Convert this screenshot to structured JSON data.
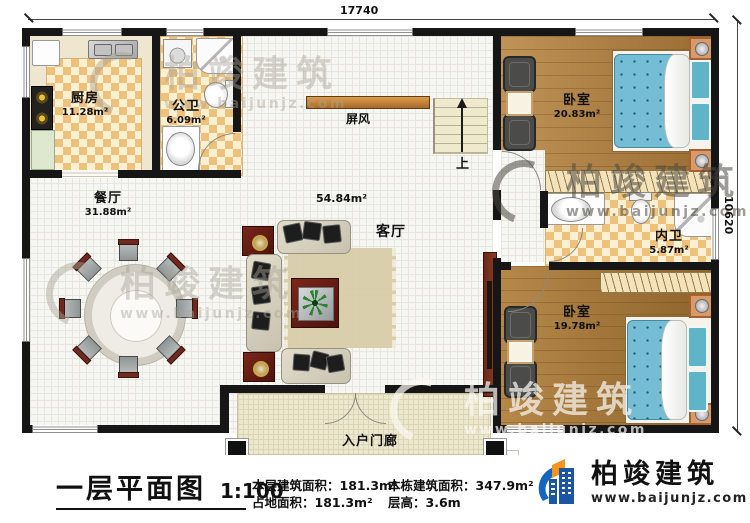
{
  "plan": {
    "dimension_top": "17740",
    "dimension_right": "10620",
    "rooms": {
      "kitchen": {
        "name": "厨房",
        "area": "11.28m²"
      },
      "public_bath": {
        "name": "公卫",
        "area": "6.09m²"
      },
      "dining": {
        "name": "餐厅",
        "area": "31.88m²"
      },
      "living": {
        "name": "客厅",
        "area": "54.84m²"
      },
      "screen": {
        "name": "屏风"
      },
      "stairs_up": {
        "name": "上"
      },
      "bedroom_top": {
        "name": "卧室",
        "area": "20.83m²"
      },
      "inner_bath": {
        "name": "内卫",
        "area": "5.87m²"
      },
      "bedroom_bottom": {
        "name": "卧室",
        "area": "19.78m²"
      },
      "porch": {
        "name": "入户门廊"
      }
    }
  },
  "watermark": {
    "text": "柏竣建筑",
    "url": "www.baijunjz.com"
  },
  "footer": {
    "title": "一层平面图",
    "scale": "1:100",
    "stats": [
      {
        "label": "本层建筑面积：",
        "value": "181.3m²"
      },
      {
        "label": "占地面积：",
        "value": "181.3m²"
      },
      {
        "label": "本栋建筑面积：",
        "value": "347.9m²"
      },
      {
        "label": "层高：",
        "value": "3.6m"
      }
    ],
    "brand": {
      "name": "柏竣建筑",
      "url": "www.baijunjz.com"
    }
  },
  "colors": {
    "wall": "#161616",
    "wood_floor": "#b5813c",
    "checker_tile": "#eec27d",
    "bed_blue": "#74bdd4",
    "brand_blue": "#1b55a4",
    "brand_orange": "#f7941d"
  }
}
